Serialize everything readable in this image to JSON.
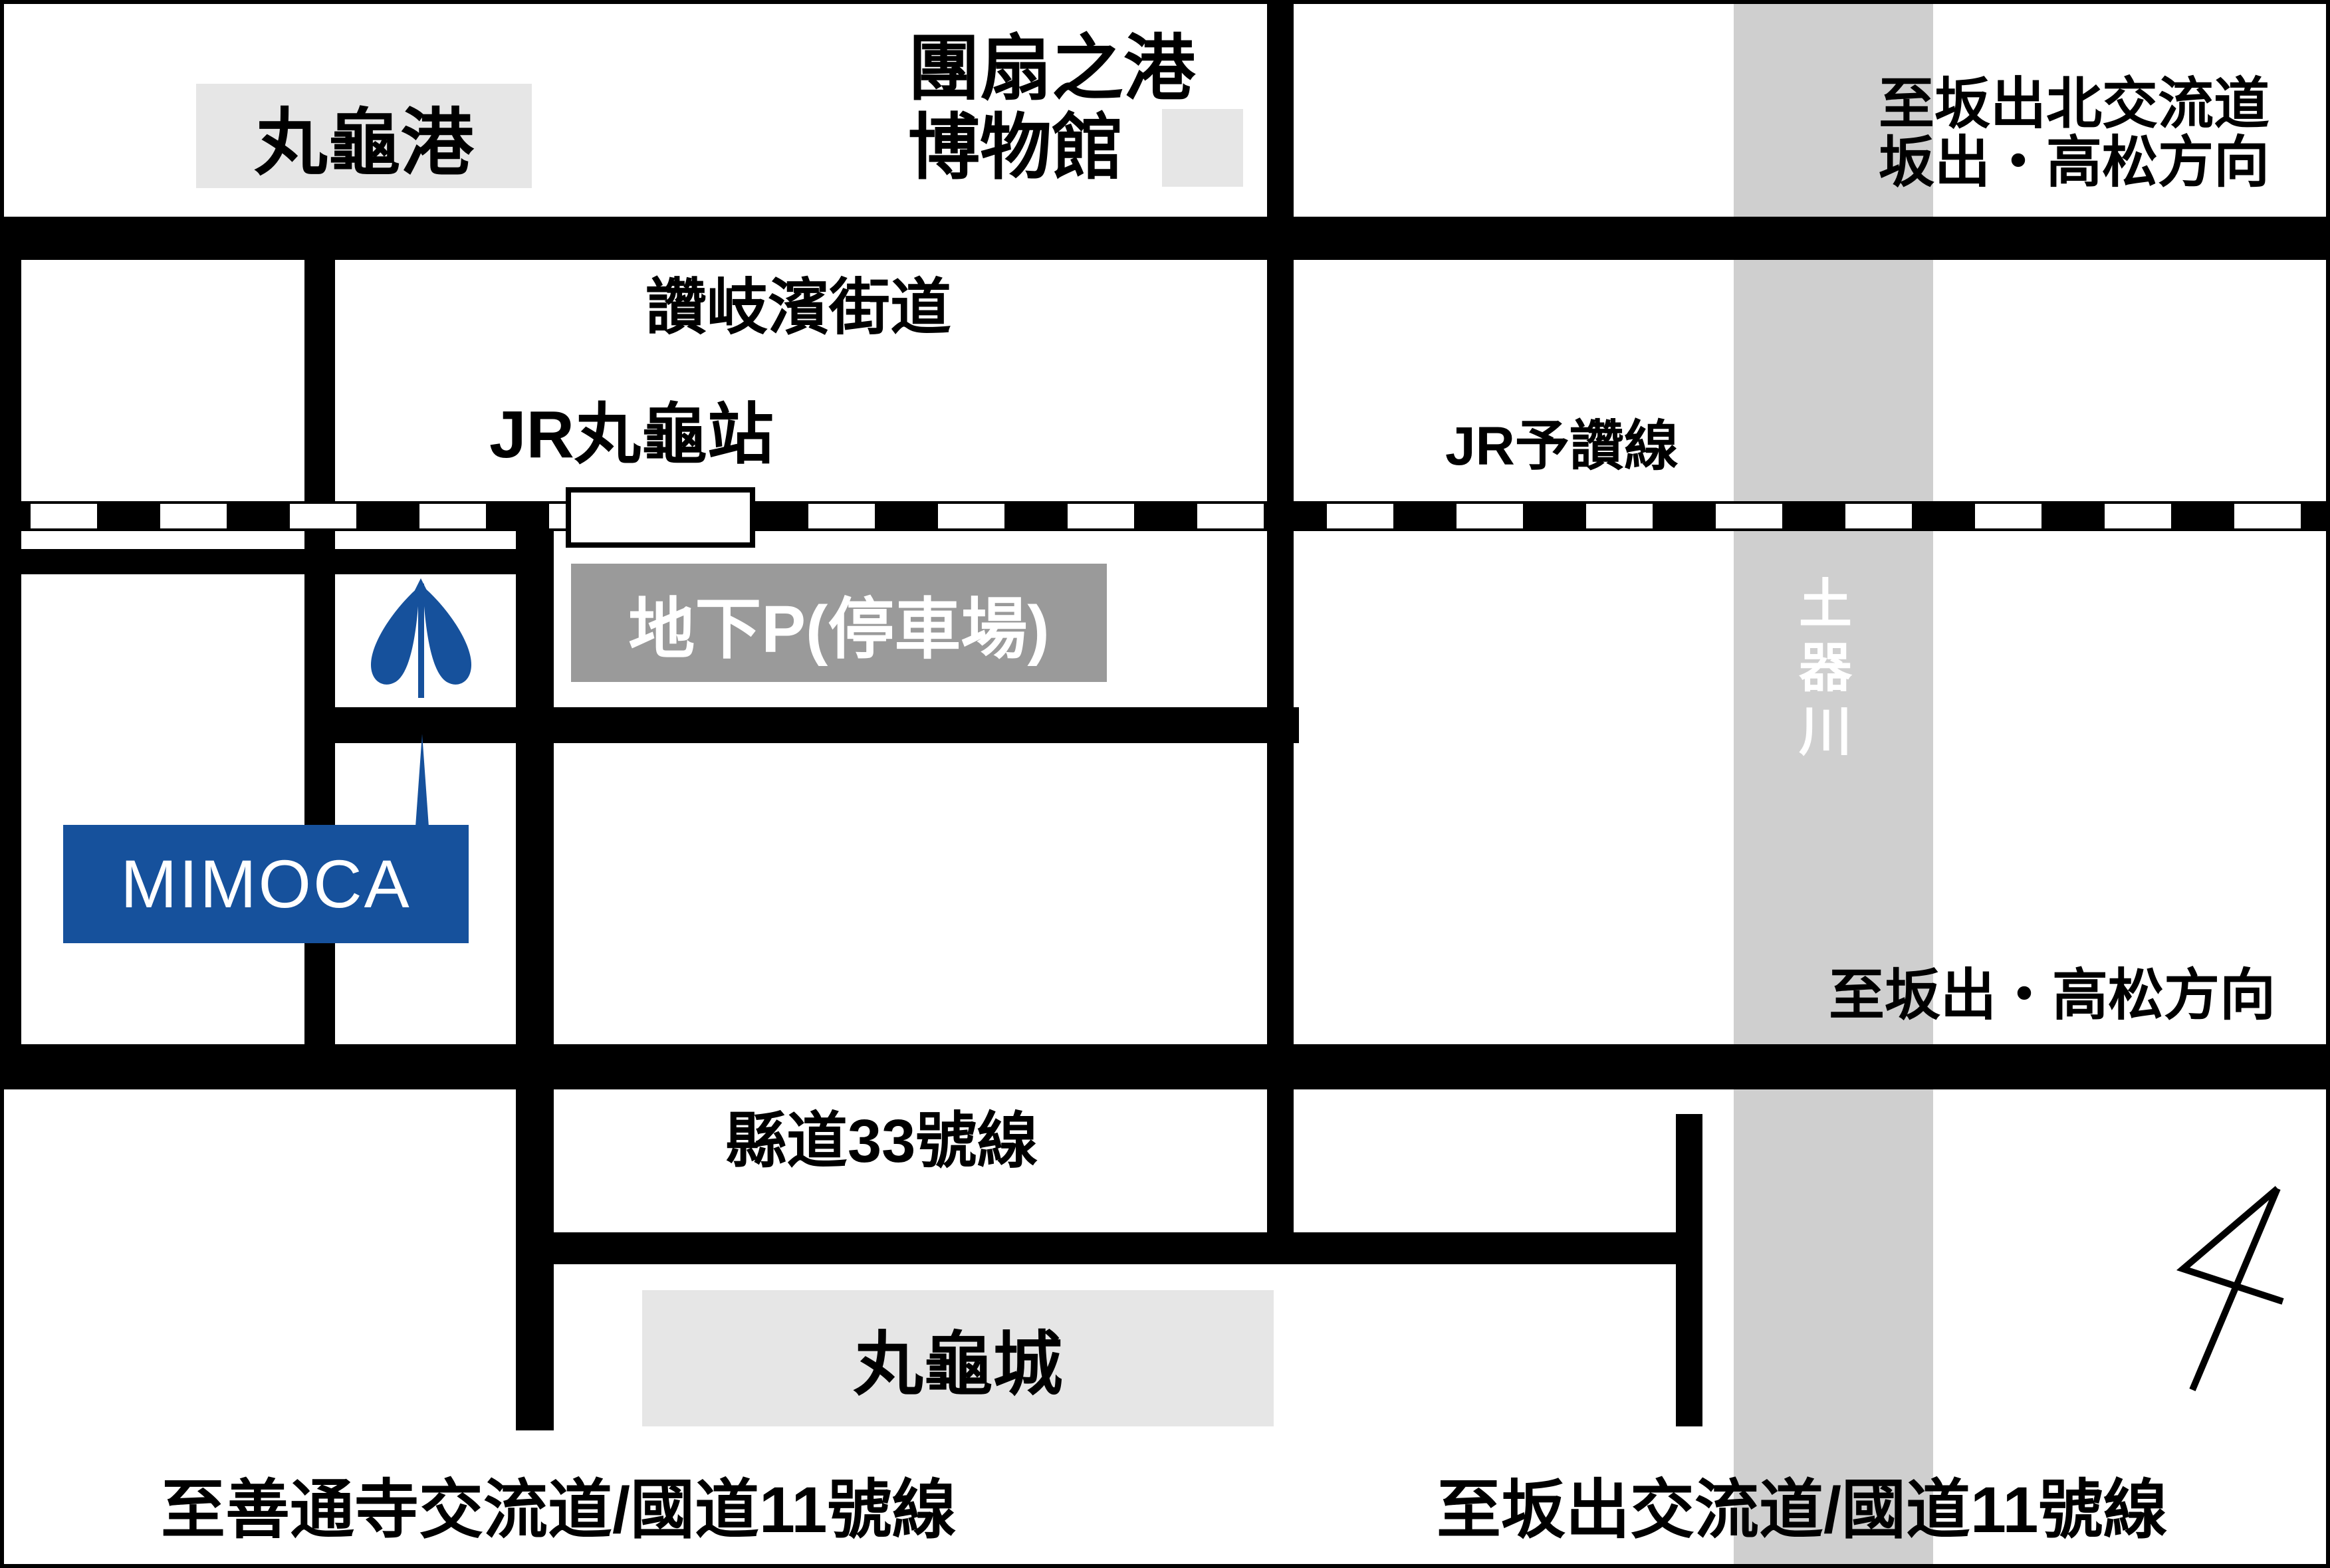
{
  "map": {
    "type": "access-map",
    "colors": {
      "road_black": "#000000",
      "river_gray": "#cfcfcf",
      "landmark_gray": "#e6e6e6",
      "parking_gray": "#9a9a9a",
      "accent_blue": "#16519c",
      "background": "#ffffff"
    },
    "labels": {
      "marugame_port": "丸龜港",
      "museum_line1": "團扇之港",
      "museum_line2": "博物館",
      "to_sakaide_kita_line1": "至坂出北交流道",
      "to_sakaide_kita_line2": "坂出・高松方向",
      "sanuki_hama_kaido": "讚岐濱街道",
      "jr_marugame_station": "JR丸龜站",
      "jr_yosan_line": "JR予讚線",
      "underground_parking": "地下P(停車場)",
      "doki_river": "土器川",
      "mimoca": "MIMOCA",
      "to_sakaide_takamatsu": "至坂出・高松方向",
      "prefectural_route_33": "縣道33號線",
      "marugame_castle": "丸龜城",
      "to_zentsuji_ic": "至善通寺交流道/國道11號線",
      "to_sakaide_ic": "至坂出交流道/國道11號線"
    },
    "icons": {
      "tree_icon": "mimoca-tree-symbol",
      "north_arrow": "hand-drawn-north-arrow"
    }
  }
}
